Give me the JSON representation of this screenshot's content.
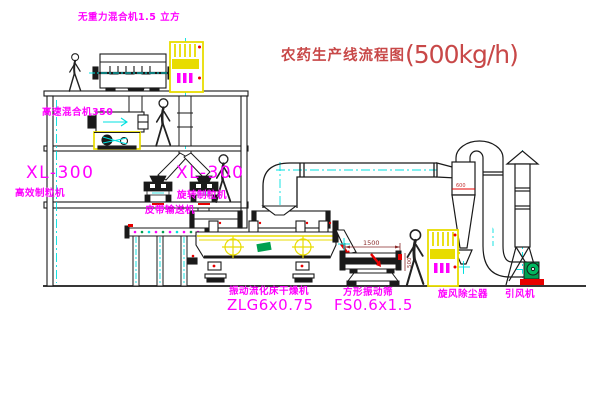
{
  "title": {
    "text": "农药生产线流程图",
    "capacity": "(500kg/h)"
  },
  "labels": {
    "top_mixer": "无重力混合机1.5 立方",
    "second_mixer": "高速混合机350",
    "granulator_left_model": "XL-300",
    "granulator_left_name": "高效制粒机",
    "granulator_right_model": "XL-300",
    "granulator_right_name": "旋转制粒机",
    "belt_conveyor": "皮带输送机",
    "dryer_name": "振动流化床干燥机",
    "dryer_model": "ZLG6x0.75",
    "sieve_name": "方形振动筛",
    "sieve_model": "FS0.6x1.5",
    "cyclone": "旋风除尘器",
    "induced_fan": "引风机"
  },
  "dimensions": {
    "sieve_length": "1500",
    "sieve_height": "500",
    "cyclone_note": "600"
  },
  "colors": {
    "label_magenta": "#ff00ff",
    "title_red": "#c84848",
    "machine_yellow": "#e8dc00",
    "centerline_cyan": "#00e0e0",
    "accent_red": "#e80000",
    "accent_green": "#00a050",
    "line_black": "#1a1a1a"
  }
}
